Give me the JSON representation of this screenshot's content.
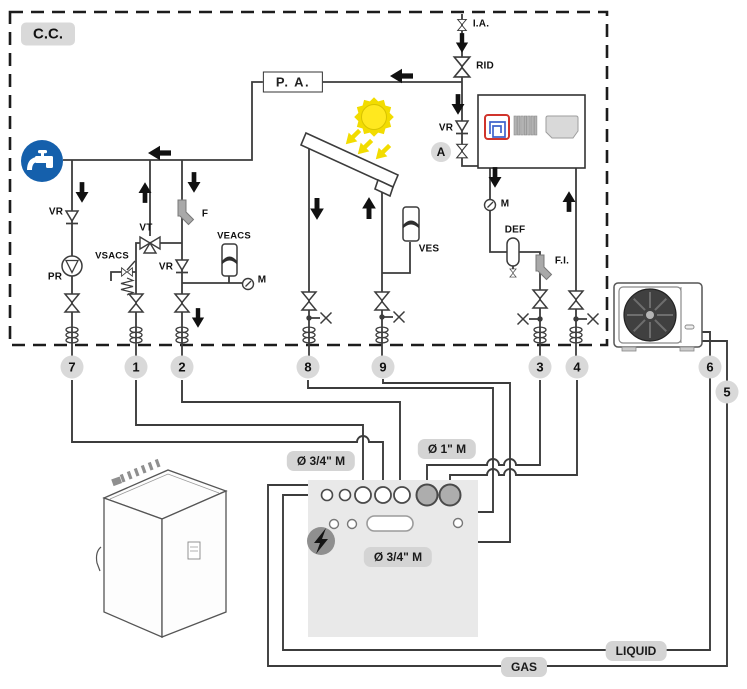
{
  "diagram": {
    "zone_label": "C.C.",
    "pump_assembly_label": "P. A.",
    "labels": {
      "air_vent": "I.A.",
      "rid": "RID",
      "check_valve": "VR",
      "zone_a": "A",
      "gauge": "M",
      "dirt_separator": "DEF",
      "line_filter": "F.I.",
      "filter": "F",
      "pump": "PR",
      "mixing_valve": "VT",
      "dhw_safety_valve": "VSACS",
      "dhw_expansion_vessel": "VEACS",
      "solar_expansion_vessel": "VES"
    },
    "connections": [
      "7",
      "1",
      "2",
      "8",
      "9",
      "3",
      "4",
      "6",
      "5"
    ],
    "ports": {
      "dhw": "Ø 3/4\" M",
      "heating": "Ø 1\" M",
      "solar": "Ø 3/4\" M"
    },
    "refrigerant": {
      "liquid": "LIQUID",
      "gas": "GAS"
    }
  }
}
